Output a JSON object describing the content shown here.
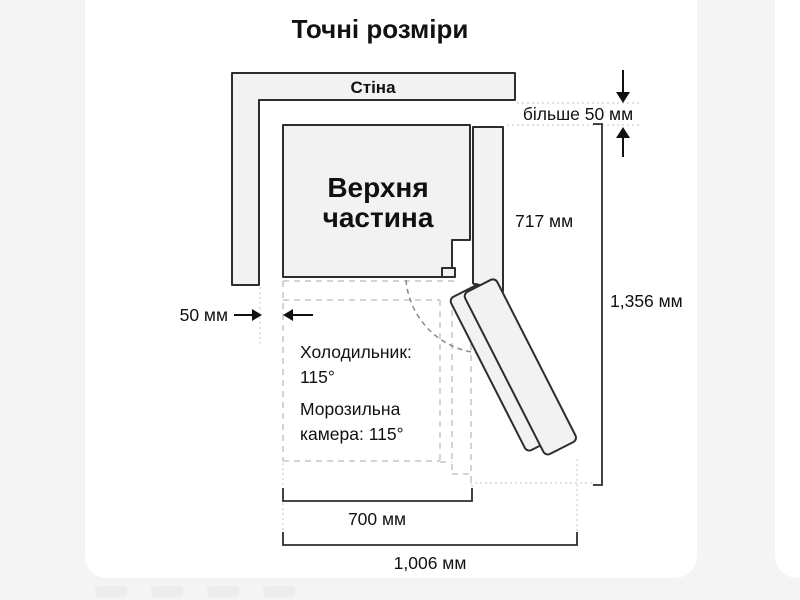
{
  "page": {
    "background_color": "#f4f4f4",
    "card_color": "#ffffff",
    "line_color": "#2d2d2d",
    "dashed_color": "#c5c5c5",
    "shape_fill_color": "#f2f2f2"
  },
  "diagram": {
    "title": "Точні розміри",
    "wall_label": "Стіна",
    "upper_label_1": "Верхня",
    "upper_label_2": "частина",
    "clearance_top": "більше 50 мм",
    "clearance_side": "50 мм",
    "depth_top": "717 мм",
    "total_depth": "1,356 мм",
    "fridge_line1": "Холодильник:",
    "fridge_line2": "115°",
    "freezer_line1": "Морозильна",
    "freezer_line2": "камера: 115°",
    "width_inner": "700 мм",
    "width_total": "1,006 мм"
  }
}
